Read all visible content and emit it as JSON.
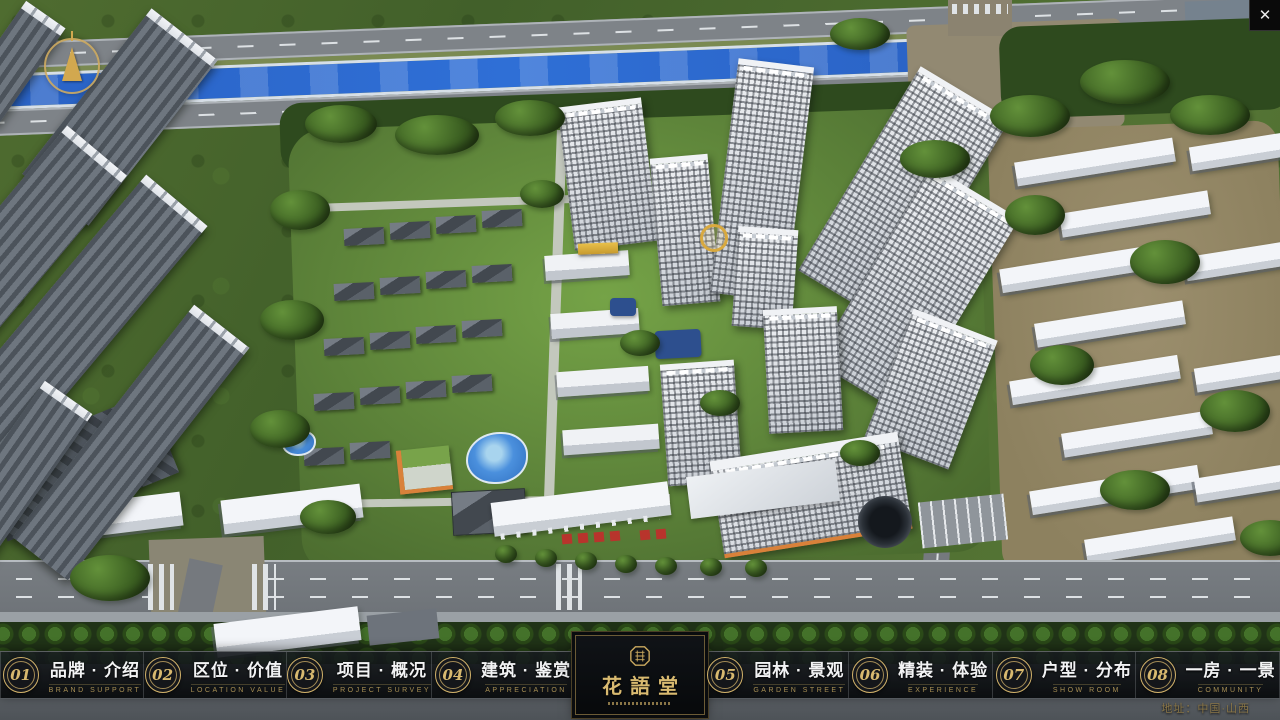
{
  "app": {
    "close_label": "✕"
  },
  "navbar": {
    "items": [
      {
        "number": "01",
        "label": "品牌 · 介绍",
        "sublabel": "BRAND SUPPORT"
      },
      {
        "number": "02",
        "label": "区位 · 价值",
        "sublabel": "LOCATION VALUE"
      },
      {
        "number": "03",
        "label": "项目 · 概况",
        "sublabel": "PROJECT SURVEY"
      },
      {
        "number": "04",
        "label": "建筑 · 鉴赏",
        "sublabel": "APPRECIATION"
      },
      {
        "number": "05",
        "label": "园林 · 景观",
        "sublabel": "GARDEN STREET"
      },
      {
        "number": "06",
        "label": "精装 · 体验",
        "sublabel": "EXPERIENCE"
      },
      {
        "number": "07",
        "label": "户型 · 分布",
        "sublabel": "SHOW ROOM"
      },
      {
        "number": "08",
        "label": "一房 · 一景",
        "sublabel": "COMMUNITY"
      }
    ],
    "logo": {
      "title": "花語堂"
    }
  },
  "footer": {
    "address": "地址：中国·山西"
  },
  "colors": {
    "gold": "#d2b26a",
    "bar_bg": "#0a0d10",
    "river_blue": "#2f6fd6"
  }
}
